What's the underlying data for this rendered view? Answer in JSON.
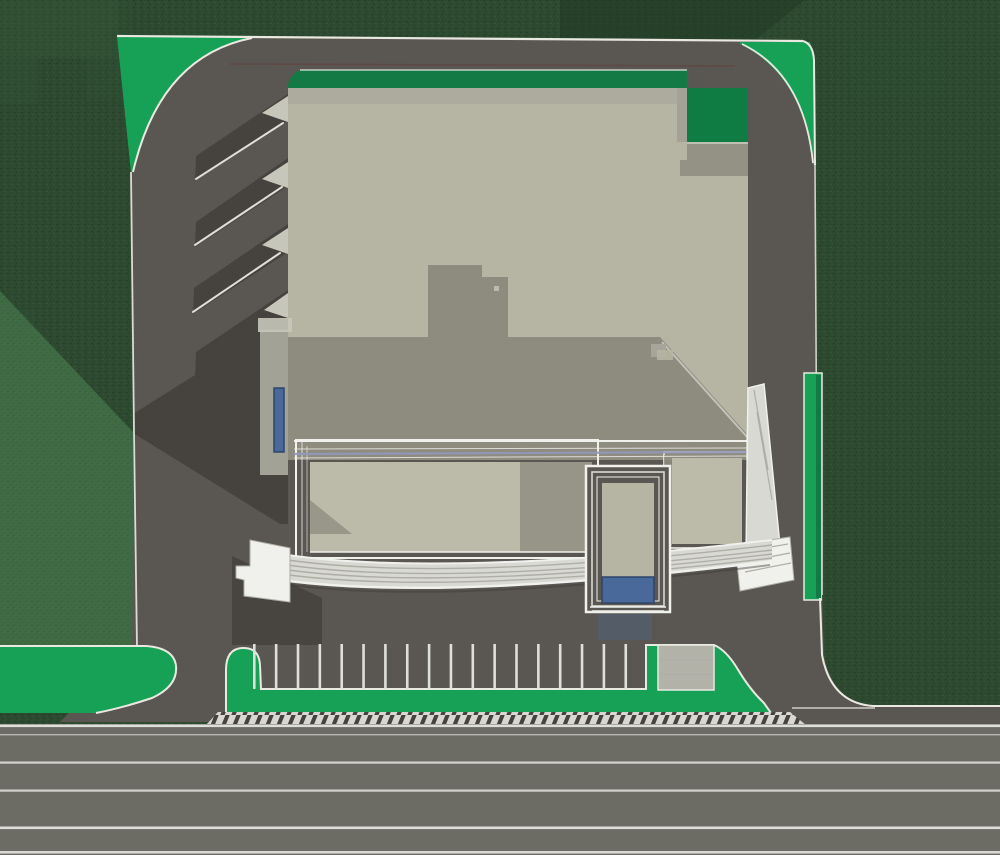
{
  "scene": {
    "alt": "Aerial site plan rendering: beige flat-roof building with entrance tower and curved front steps, asphalt driveway loop, parking row with striped stalls, green lawn islands, hatched sidewalk and multi-lane road at bottom",
    "palette": {
      "forest": "#2d4a30",
      "forestLight": "#3a5b3f",
      "forestDark": "#203825",
      "lawn": "#3f6a44",
      "lawnSpeck": "#36603c",
      "brightGreen": "#17a156",
      "plantDark": "#147a45",
      "notchGreen": "#0f7c44",
      "curb": "#e9e9e1",
      "asphalt": "#5a5752",
      "shadow": "#46433e",
      "road": "#6c6b64",
      "roofBeige": "#b6b5a3",
      "roofShadow": "#8d8c7f",
      "roofTopBand": "#a6a599",
      "wallLight": "#a3a296",
      "toothLight": "#c7c6ba",
      "wingFrame": "#f0f0ec",
      "wingInner": "#bcbbaa",
      "wingShade": "#8f8e81",
      "stepFill": "#d9d9d3",
      "stepLine": "#aeaea6",
      "lavender": "#9298bb",
      "blueGlass": "#48699a",
      "blueDark": "#2e4568",
      "padGray": "#b3b2a8",
      "laneWhite": "#dfdfd9",
      "hatchBg": "#d8d8d0",
      "hatchDark": "#46433e",
      "maroon": "#643c37"
    },
    "parking": {
      "stripe_count": 18,
      "start_x": 253,
      "spacing": 21.85,
      "top_y": 644,
      "bottom_y": 689,
      "stripe_width": 2.6
    },
    "road": {
      "top_y": 724,
      "height": 131,
      "lane_lines": [
        {
          "y": 724.5,
          "w": 2.6,
          "o": 1
        },
        {
          "y": 734.0,
          "w": 1.4,
          "o": 0.65
        },
        {
          "y": 761.5,
          "w": 2.2,
          "o": 0.9
        },
        {
          "y": 789.5,
          "w": 2.2,
          "o": 0.9
        },
        {
          "y": 826.5,
          "w": 2.6,
          "o": 1
        },
        {
          "y": 851.0,
          "w": 2.6,
          "o": 0.95
        }
      ]
    },
    "hatch": {
      "left": 206,
      "right": 806,
      "top": 712,
      "bottom": 725
    }
  }
}
